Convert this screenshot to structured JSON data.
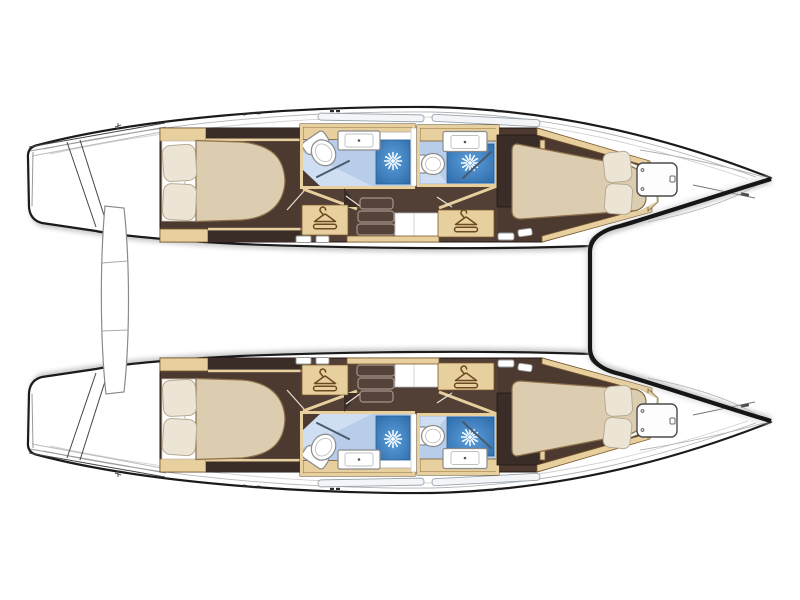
{
  "image": {
    "type": "yacht-floor-plan",
    "subject": "catamaran layout, top view, bow pointing right, no text labels",
    "hulls": [
      {
        "name": "port-hull",
        "rooms": [
          {
            "name": "aft-double-cabin",
            "features": [
              "double-berth",
              "two-pillows",
              "shelves"
            ]
          },
          {
            "name": "aft-bathroom",
            "features": [
              "toilet",
              "sink",
              "separate-shower"
            ]
          },
          {
            "name": "forward-bathroom",
            "features": [
              "toilet",
              "sink",
              "separate-shower"
            ]
          },
          {
            "name": "companionway",
            "features": [
              "stairs-3-steps",
              "landing",
              "wardrobe",
              "wardrobe"
            ]
          },
          {
            "name": "forward-double-cabin",
            "features": [
              "double-berth",
              "two-pillows"
            ]
          },
          {
            "name": "bow-deck",
            "features": [
              "deck-hatch",
              "anchor-fitting"
            ]
          }
        ]
      },
      {
        "name": "starboard-hull",
        "rooms": [
          {
            "name": "aft-double-cabin",
            "features": [
              "double-berth",
              "two-pillows",
              "shelves"
            ]
          },
          {
            "name": "aft-bathroom",
            "features": [
              "toilet",
              "sink",
              "separate-shower"
            ]
          },
          {
            "name": "forward-bathroom",
            "features": [
              "toilet",
              "sink",
              "separate-shower"
            ]
          },
          {
            "name": "companionway",
            "features": [
              "stairs-3-steps",
              "landing",
              "wardrobe",
              "wardrobe"
            ]
          },
          {
            "name": "forward-double-cabin",
            "features": [
              "double-berth",
              "two-pillows"
            ]
          },
          {
            "name": "bow-deck",
            "features": [
              "deck-hatch",
              "anchor-fitting"
            ]
          }
        ]
      }
    ],
    "between_hulls": [
      "stern-crossbar",
      "trampoline-foredeck-edge"
    ],
    "icons": [
      "coat-hanger-icon",
      "shower-spray-icon",
      "toilet-icon",
      "sink-icon",
      "deck-hatch-icon",
      "stairs-icon"
    ],
    "counts": {
      "double_berths": 4,
      "bathrooms": 4,
      "showers": 4,
      "wardrobes": 4,
      "stair_sets": 2,
      "bow_hatches": 2
    }
  },
  "palette": {
    "line": "#1b1b1b",
    "wood": "#e8d09e",
    "wood-line": "#7c5a2c",
    "floor": "#4c3a31",
    "floor-dark": "#3a2c26",
    "bath": "#b7cde9",
    "bath-pale": "#cfdef2",
    "shower-hi": "#5ba0dc",
    "shower-lo": "#2f6dab",
    "bed": "#dccdb0",
    "bed-line": "#8d6f49",
    "pillow": "#ece5d6",
    "pillow-line": "#b6ab93",
    "icon": "#6b4a22"
  }
}
